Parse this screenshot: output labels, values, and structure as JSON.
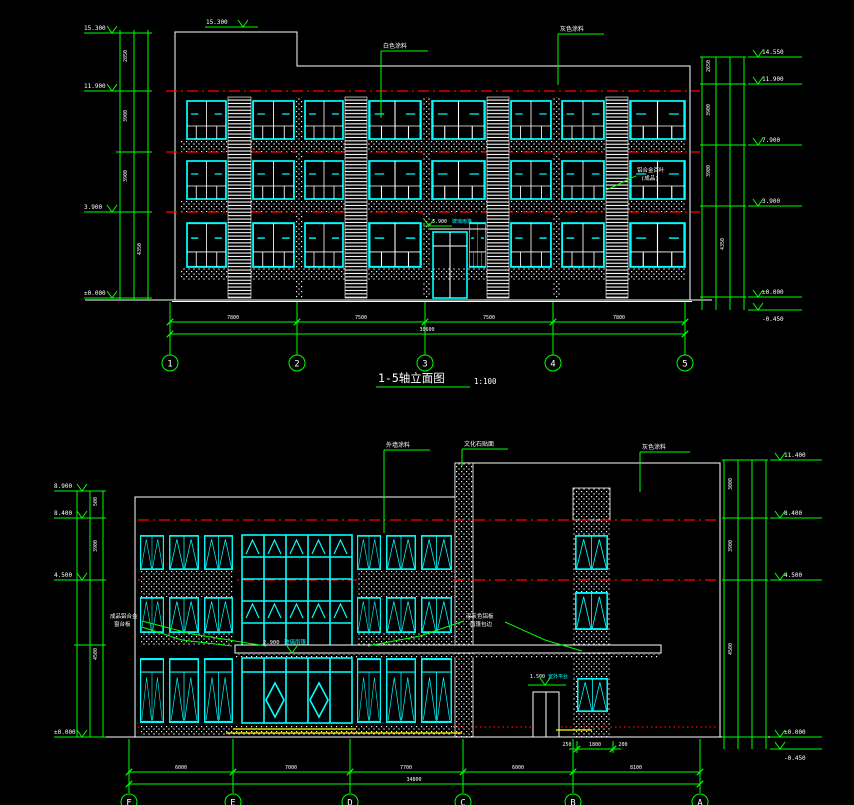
{
  "colors": {
    "green": "#00ff00",
    "cyan": "#00ffff",
    "red": "#ff0000",
    "white": "#ffffff",
    "yellow": "#ffff00",
    "background": "#000000"
  },
  "drawing1": {
    "title": "1-5轴立面图",
    "scale": "1:100",
    "bubbles": [
      "1",
      "2",
      "3",
      "4",
      "5"
    ],
    "bay_dims": [
      "7800",
      "7500",
      "7500",
      "7800"
    ],
    "total_dim": "30600",
    "level_parapet": "15.300",
    "levels_left": [
      "15.300",
      "11.900",
      "3.900",
      "±0.000"
    ],
    "levels_right": [
      "14.550",
      "11.900",
      "7.900",
      "3.900",
      "±0.000",
      "-0.450"
    ],
    "vdims_left": [
      "2850",
      "3900",
      "3900",
      "4350"
    ],
    "vdims_right": [
      "2650",
      "3900",
      "3900",
      "4350"
    ],
    "notes": {
      "paint1": "白色涂料",
      "paint2": "灰色涂料",
      "louver1": "铝合金百叶",
      "louver2": "(成品)",
      "canopy_value": "3.900",
      "canopy_label": "玻璃雨篷"
    }
  },
  "drawing2": {
    "bubbles": [
      "F",
      "E",
      "D",
      "C",
      "B",
      "A"
    ],
    "bay_dims": [
      "6000",
      "7000",
      "7700",
      "6000",
      "8100"
    ],
    "total_dim": "34800",
    "levels_left": [
      "8.900",
      "8.400",
      "4.500",
      "±0.000"
    ],
    "levels_right": [
      "11.400",
      "8.400",
      "4.500",
      "±0.000",
      "-0.450"
    ],
    "vdims_left": [
      "500",
      "3900",
      "4500"
    ],
    "vdims_right": [
      "3000",
      "3900",
      "4500"
    ],
    "sub_dims": [
      "250",
      "1800",
      "200"
    ],
    "notes": {
      "n1": "外墙涂料",
      "n2": "文化石贴面",
      "n3": "灰色涂料",
      "left1": "成品铝合金",
      "left2": "窗台板",
      "right1": "深灰色铝板",
      "right2": "雨篷包边",
      "canopy_value": "2.900",
      "canopy_label": "玻璃雨篷",
      "door_value": "1.500",
      "door_label": "室外平台"
    }
  }
}
